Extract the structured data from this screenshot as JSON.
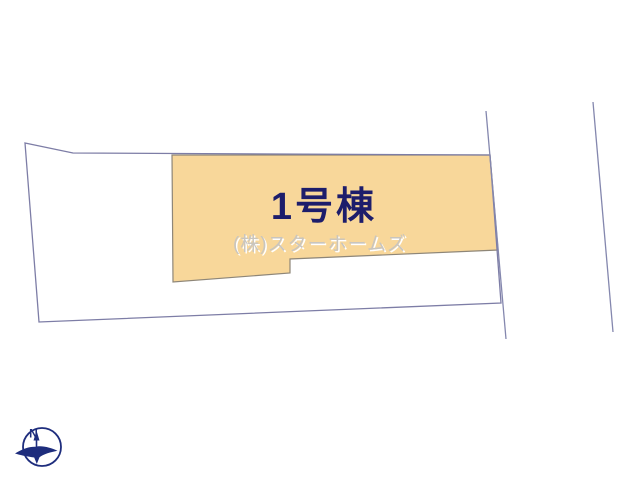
{
  "plan": {
    "building_label": "1号棟",
    "watermark": "(株)スターホームズ",
    "compass_label": "N"
  },
  "colors": {
    "background": "#ffffff",
    "parcel_line": "#7d7da6",
    "road_line": "#8487ae",
    "building_fill": "#f8d79a",
    "building_stroke": "#8e8678",
    "building_label_color": "#1d1d6b",
    "watermark_color": "#c9c5be",
    "watermark_highlight": "#ffffff",
    "compass_color": "#1e2d7d"
  },
  "geometry": {
    "parcel_points": "25,143 73,153 490,155 501,303 39,322",
    "building_points": "172,155 490,155 498,250 290,259 290,273 173,282",
    "road_left_points": "486,111 506,339",
    "road_right_points": "593,102 613,332"
  }
}
